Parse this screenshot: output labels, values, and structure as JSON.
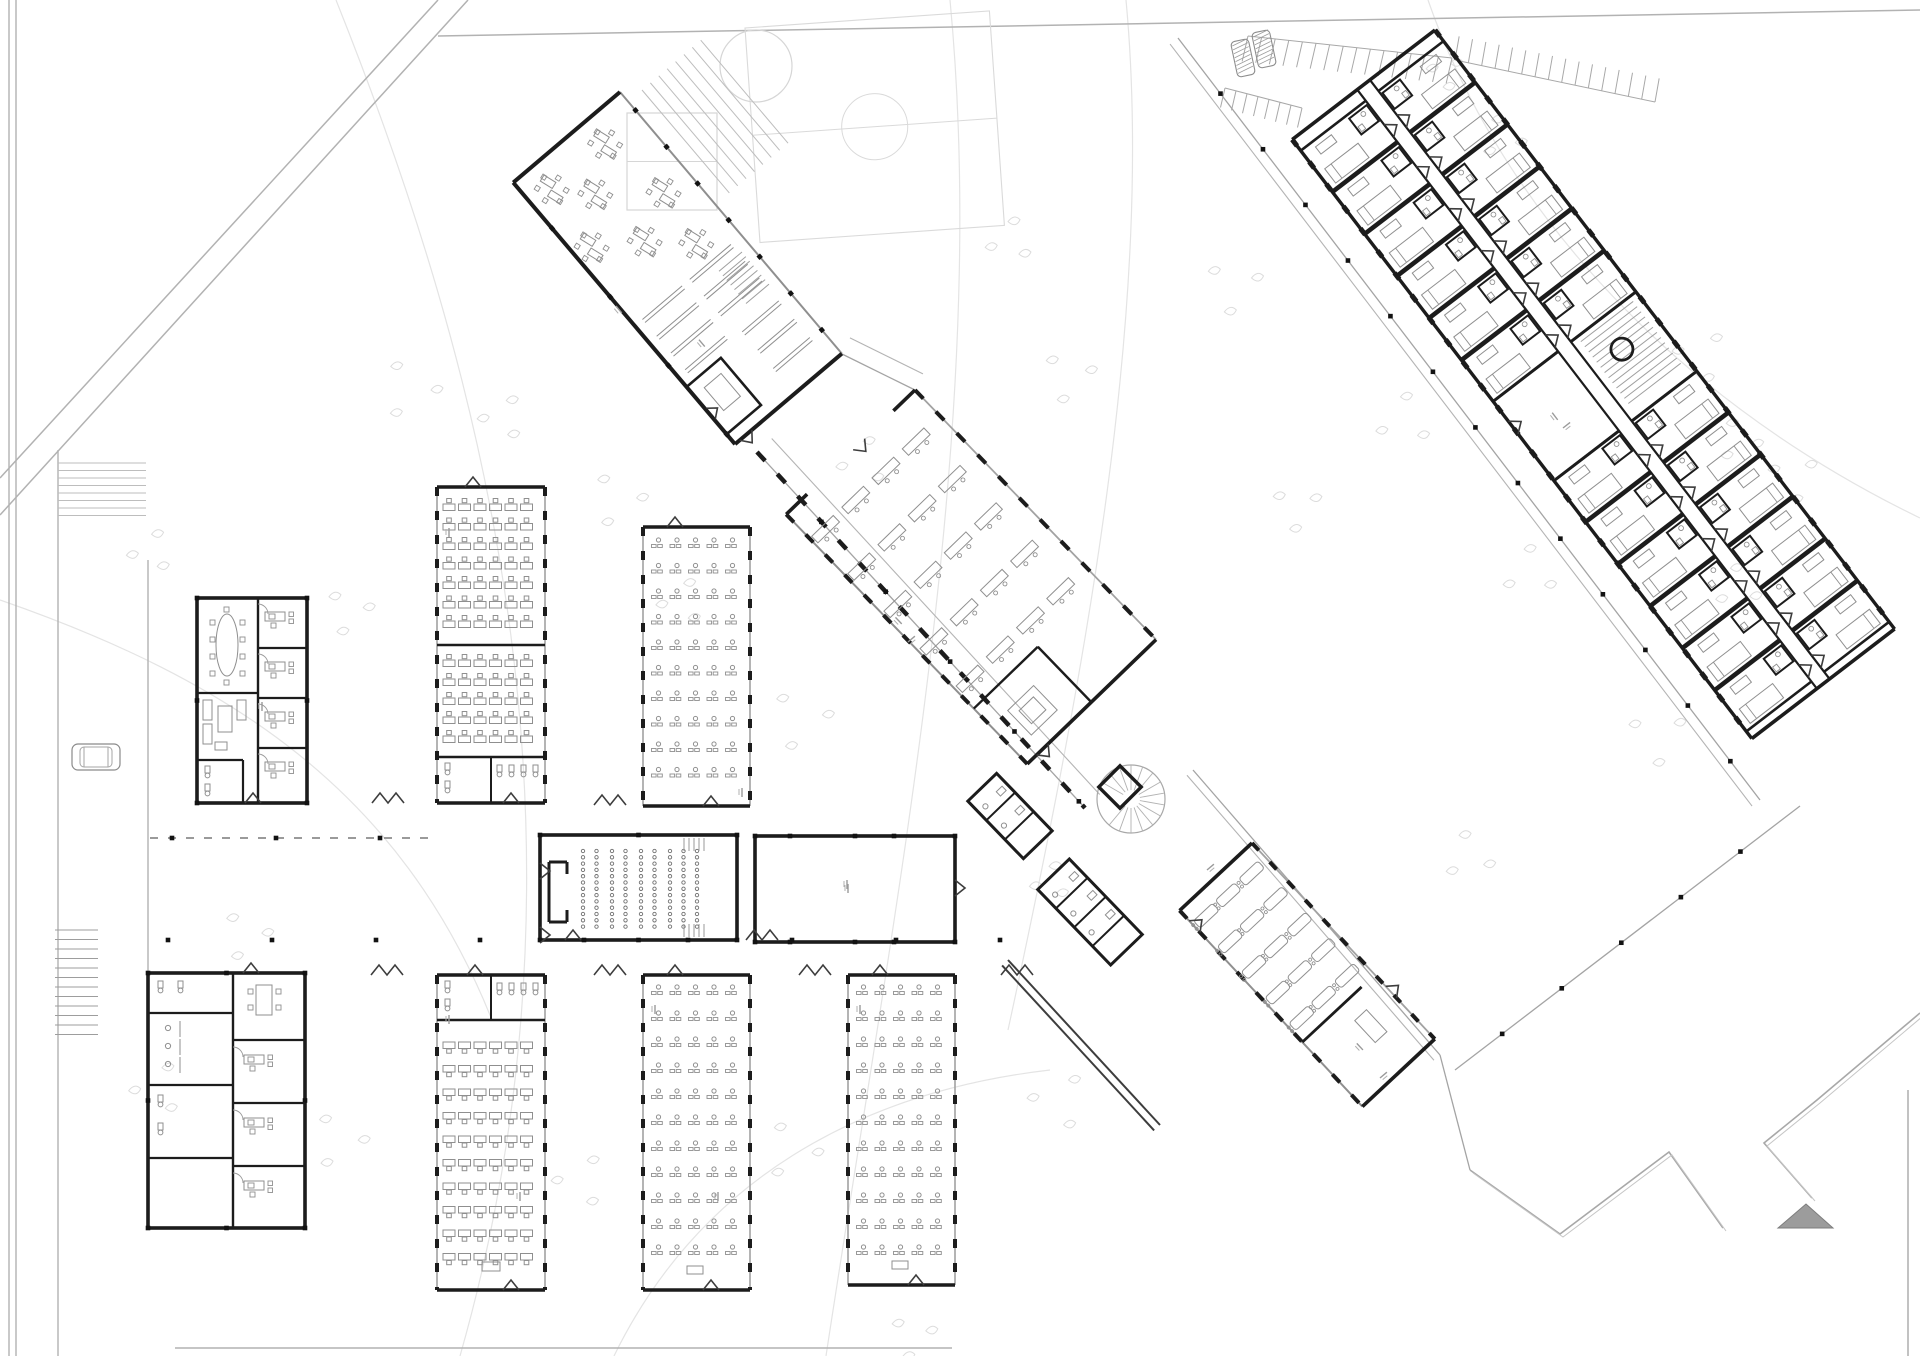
{
  "canvas": {
    "w": 1920,
    "h": 1356,
    "bg": "#ffffff"
  },
  "colors": {
    "wall": "#1c1c1c",
    "wall2": "#3d3d3d",
    "gray": "#8f8f8f",
    "siteline": "#b2b2b2",
    "faint": "#e4e4e4",
    "tree": "#cfcfcf",
    "treeInner": "#dcdcdc",
    "furn": "#8f8f8f",
    "furnLight": "#bdbdbd",
    "dot": "#121212",
    "triangleFill": "#9c9c9c",
    "triangleEdge": "#7d7d7d"
  },
  "site": {
    "verticals": [
      [
        9,
        0,
        9,
        1356
      ],
      [
        16,
        0,
        16,
        1356
      ],
      [
        58,
        450,
        58,
        1356
      ],
      [
        148,
        560,
        148,
        1060
      ]
    ],
    "diagonals": [
      [
        0,
        478,
        438,
        0
      ],
      [
        0,
        515,
        468,
        0
      ],
      [
        438,
        36,
        1920,
        10
      ]
    ],
    "bottom": [
      [
        175,
        1348,
        952,
        1348
      ]
    ],
    "right": [
      [
        1908,
        1090,
        1908,
        1356
      ]
    ],
    "contours": [
      "M336,0 C480,360 610,830 460,1356",
      "M950,0 C990,420 900,870 826,1356",
      "M1126,0 C1154,300 1088,660 1008,1030",
      "M1428,0 C1494,190 1656,390 1920,518",
      "M0,600 C230,680 400,790 492,1020",
      "M614,1356 C700,1180 860,1092 1050,1070"
    ],
    "zigzagBoundary": [
      "M1470,1170 L1560,1234 L1669,1152 L1723,1228",
      "M1920,1013 L1817,1100 L1764,1143 L1812,1198"
    ],
    "triangle": "1778,1228 1833,1228 1806,1204",
    "zebra": {
      "x": 58,
      "y": 463,
      "w": 88,
      "h": 53,
      "step": 7.5
    },
    "stairs": {
      "x": 55,
      "y": 930,
      "w": 43,
      "h": 108,
      "step": 9.5
    },
    "car": {
      "x": 72,
      "y": 744,
      "w": 48,
      "h": 26
    }
  },
  "trees": [
    [
      404,
      390,
      60
    ],
    [
      497,
      418,
      44
    ],
    [
      612,
      500,
      55
    ],
    [
      676,
      602,
      45
    ],
    [
      795,
      720,
      62
    ],
    [
      857,
      462,
      48
    ],
    [
      1063,
      377,
      52
    ],
    [
      1004,
      241,
      44
    ],
    [
      1228,
      287,
      56
    ],
    [
      1398,
      421,
      54
    ],
    [
      1291,
      508,
      47
    ],
    [
      1524,
      573,
      53
    ],
    [
      1652,
      737,
      58
    ],
    [
      1732,
      588,
      44
    ],
    [
      1788,
      478,
      48
    ],
    [
      1463,
      857,
      49
    ],
    [
      1440,
      73,
      32
    ],
    [
      1497,
      138,
      42
    ],
    [
      1695,
      356,
      52
    ],
    [
      1733,
      441,
      42
    ],
    [
      1053,
      1101,
      58
    ],
    [
      786,
      1151,
      58
    ],
    [
      575,
      1181,
      53
    ],
    [
      333,
      1141,
      56
    ],
    [
      152,
      1089,
      52
    ],
    [
      240,
      936,
      49
    ],
    [
      145,
      552,
      42
    ],
    [
      343,
      612,
      46
    ],
    [
      1045,
      882,
      36
    ],
    [
      907,
      1337,
      44
    ]
  ],
  "fields": {
    "court": {
      "x": 627,
      "y": 113,
      "w": 90,
      "h": 97
    },
    "circle": [
      756,
      66,
      36
    ],
    "pitch": {
      "x": 745,
      "y": 28,
      "w": 245,
      "h": 215,
      "rot": -4
    },
    "bleachers": {
      "x": 642,
      "y": 90,
      "n": 8,
      "gap": 11,
      "len": 135,
      "deg": 49.7
    },
    "ramp": {
      "x": 742,
      "y": 252,
      "w": 44,
      "h": 30,
      "deg": 50,
      "step": 6
    }
  },
  "parking": {
    "rows": [
      {
        "x1": 1248,
        "y1": 36,
        "x2": 1452,
        "y2": 58,
        "len": 26,
        "deg": 103,
        "step": 13
      },
      {
        "x1": 1455,
        "y1": 60,
        "x2": 1655,
        "y2": 102,
        "len": 24,
        "deg": -80,
        "step": 13
      },
      {
        "x1": 1225,
        "y1": 88,
        "x2": 1302,
        "y2": 108,
        "len": 20,
        "deg": 103,
        "step": 11
      }
    ],
    "cars": [
      [
        1243,
        58,
        -12
      ],
      [
        1264,
        49,
        -12
      ]
    ]
  },
  "walkways": [
    {
      "id": "w1",
      "line": [
        1178,
        38,
        1760,
        800
      ],
      "off": 10,
      "dots": 70
    },
    {
      "id": "w2",
      "line": [
        1193,
        770,
        1440,
        1055
      ],
      "off": 8
    },
    {
      "id": "w2b",
      "line": [
        1440,
        1055,
        1470,
        1170
      ]
    },
    {
      "id": "w4",
      "line": [
        1800,
        806,
        1455,
        1070
      ],
      "dots": 75
    },
    {
      "id": "g2",
      "line": [
        757,
        452,
        1085,
        808
      ],
      "off": -20,
      "dots": 95,
      "glazed": true
    },
    {
      "id": "conn",
      "line": [
        842,
        354,
        915,
        390
      ],
      "off": -18
    }
  ],
  "corridor": {
    "colonnade": {
      "y": 838,
      "x1": 150,
      "x2": 438
    },
    "dots": {
      "y": 940,
      "x1": 168,
      "x2": 1000,
      "step": 104
    },
    "zigzags": [
      [
        371,
        975,
        0
      ],
      [
        594,
        975,
        0
      ],
      [
        799,
        975,
        0
      ],
      [
        1001,
        975,
        0
      ],
      [
        372,
        803,
        0
      ],
      [
        594,
        805,
        0
      ],
      [
        746,
        940,
        0
      ]
    ],
    "labels": [
      [
        449,
        528,
        90
      ],
      [
        449,
        1015,
        90
      ],
      [
        655,
        1005,
        90
      ],
      [
        860,
        1005,
        90
      ],
      [
        742,
        788,
        90
      ],
      [
        848,
        884,
        90
      ],
      [
        262,
        702,
        90
      ],
      [
        1563,
        428,
        -38
      ],
      [
        1380,
        1078,
        -40
      ],
      [
        1207,
        870,
        -40
      ],
      [
        908,
        642,
        -40
      ],
      [
        616,
        306,
        50
      ],
      [
        520,
        1192,
        90
      ],
      [
        718,
        1192,
        90
      ]
    ]
  },
  "buildings": [
    {
      "kind": "officesA",
      "x": 197,
      "y": 598,
      "w": 110,
      "h": 205
    },
    {
      "kind": "classroom",
      "x": 437,
      "y": 487,
      "w": 108,
      "h": 316,
      "upperRows": 7,
      "lowerRows": 5,
      "split": 645
    },
    {
      "kind": "pairroom",
      "x": 643,
      "y": 527,
      "w": 107,
      "h": 279,
      "rows": 10,
      "y0": 18,
      "step": 25.5,
      "podium": false
    },
    {
      "kind": "auditorium",
      "x": 540,
      "y": 835,
      "w": 197,
      "h": 105
    },
    {
      "kind": "hall",
      "x": 755,
      "y": 836,
      "w": 200,
      "h": 106
    },
    {
      "kind": "blockE",
      "x": 148,
      "y": 973,
      "w": 157,
      "h": 255
    },
    {
      "kind": "classroom2",
      "x": 437,
      "y": 975,
      "w": 108,
      "h": 315,
      "rows": 10
    },
    {
      "kind": "pairroom",
      "x": 643,
      "y": 975,
      "w": 107,
      "h": 315,
      "rows": 11,
      "y0": 17,
      "step": 26,
      "podium": true
    },
    {
      "kind": "pairroom",
      "x": 848,
      "y": 975,
      "w": 107,
      "h": 310,
      "rows": 11,
      "y0": 17,
      "step": 26,
      "podium": true
    },
    {
      "kind": "service",
      "cx": 1010,
      "cy": 816,
      "deg": 46,
      "len": 80,
      "dep": 40,
      "fix": 2
    },
    {
      "kind": "service",
      "cx": 1090,
      "cy": 912,
      "deg": 46,
      "len": 105,
      "dep": 44,
      "fix": 3
    },
    {
      "kind": "spiral",
      "cx": 1131,
      "cy": 799,
      "r": 34
    },
    {
      "kind": "corrDiag",
      "pts": [
        1008,
        960,
        1160,
        1125
      ]
    },
    {
      "kind": "cafeteria",
      "x": 620,
      "y": 92,
      "deg": 49.7,
      "len": 343,
      "dep": 140
    },
    {
      "kind": "deskWing",
      "x": 915,
      "y": 390,
      "deg": 46,
      "len": 347,
      "dep": 179
    },
    {
      "kind": "loungerWing",
      "x": 1252,
      "y": 843,
      "deg": 47,
      "len": 268,
      "dep": 99
    },
    {
      "kind": "dormWing",
      "x": 1435,
      "y": 30,
      "deg": 52.5,
      "len": 755,
      "dep": 180
    }
  ]
}
